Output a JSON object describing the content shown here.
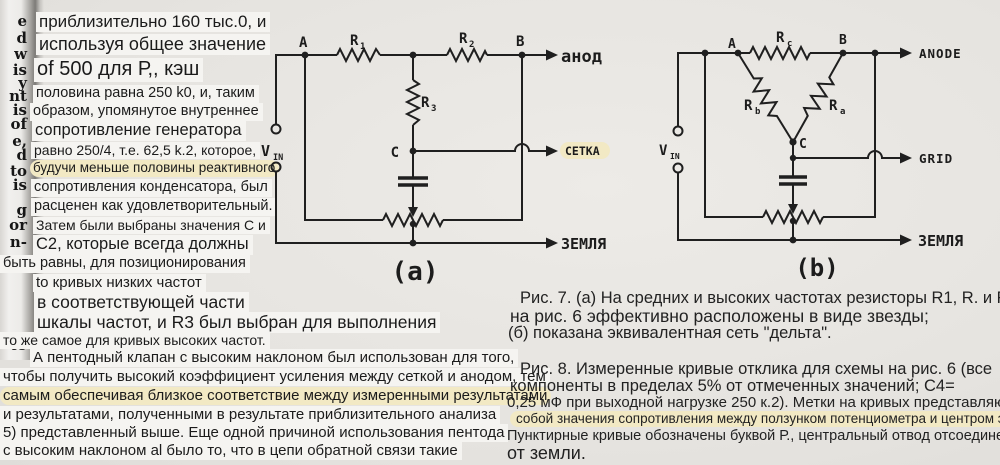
{
  "page": {
    "bg": "#e8e6e2",
    "highlight": "#f2e9c4",
    "ink": "#1c1c1c"
  },
  "gutter": {
    "fragments": [
      "e",
      "d",
      "w",
      "is",
      "y",
      "nt",
      "is",
      "of",
      "e,",
      "d",
      "to",
      "is",
      "g",
      "or",
      "n-",
      "to"
    ]
  },
  "left_column": {
    "lines": [
      "приблизительно 160 тыс.0, и",
      "используя общее значение",
      "of 500 для Р,, кэш",
      "половина равна 250 k0, и, таким",
      "образом, упомянутое внутреннее",
      "сопротивление генератора",
      "равно 250/4, т.е. 62,5 k.2, которое,",
      "будучи меньше половины реактивного",
      "сопротивления конденсатора, был",
      "расценен как удовлетворительный.",
      "Затем были выбраны значения С и",
      "С2, которые всегда должны",
      "быть равны, для позиционирования",
      "to кривых низких частот",
      "в соответствующей части",
      "шкалы частот, и R3 был выбран для выполнения",
      "то же самое для кривых высоких частот."
    ]
  },
  "paragraph": {
    "lines": [
      "А пентодный клапан с высоким наклоном был использован для того,",
      "чтобы получить высокий коэффициент усиления между сеткой и анодом, тем",
      "самым обеспечивая близкое соответствие между измеренными результатами",
      "и результатами, полученными в результате приблизительного анализа",
      "5) представленный выше. Еще одной причиной использования пентода",
      "с высоким наклоном al было то, что в цепи обратной связи такие"
    ]
  },
  "fig_a": {
    "node_a": "A",
    "node_b": "B",
    "node_c": "C",
    "r1_base": "R",
    "r1_sub": "1",
    "r2_base": "R",
    "r2_sub": "2",
    "r3_base": "R",
    "r3_sub": "3",
    "v_base": "V",
    "v_sub": "IN",
    "out_top": "анод",
    "out_mid": "СЕТКА",
    "out_bottom": "ЗЕМЛЯ",
    "tag": "(a)"
  },
  "fig_b": {
    "node_a": "A",
    "node_b": "B",
    "node_c": "C",
    "rc_base": "R",
    "rc_sub": "c",
    "rb_base": "R",
    "rb_sub": "b",
    "ra_base": "R",
    "ra_sub": "a",
    "v_base": "V",
    "v_sub": "IN",
    "out_top": "ANODE",
    "out_mid": "GRID",
    "out_bottom": "ЗЕМЛЯ",
    "tag": "(b)"
  },
  "captions": {
    "fig7_lines": [
      "Рис. 7. (а) На средних и высоких частотах резисторы R1, R. и R",
      "на рис. 6 эффективно расположены в виде звезды;",
      "(б) показана эквивалентная сеть \"дельта\"."
    ],
    "fig8_lines": [
      "Рис. 8. Измеренные кривые отклика для схемы на рис. 6 (все",
      "компоненты в пределах 5% от отмеченных значений; С4=",
      "0,25 мФ при выходной нагрузке 250 к.2). Метки на кривых представляют",
      "собой значения сопротивления между ползунком потенциометра и центром элемента.",
      "Пунктирные кривые обозначены буквой Р., центральный отвод отсоединен",
      "от земли."
    ]
  }
}
